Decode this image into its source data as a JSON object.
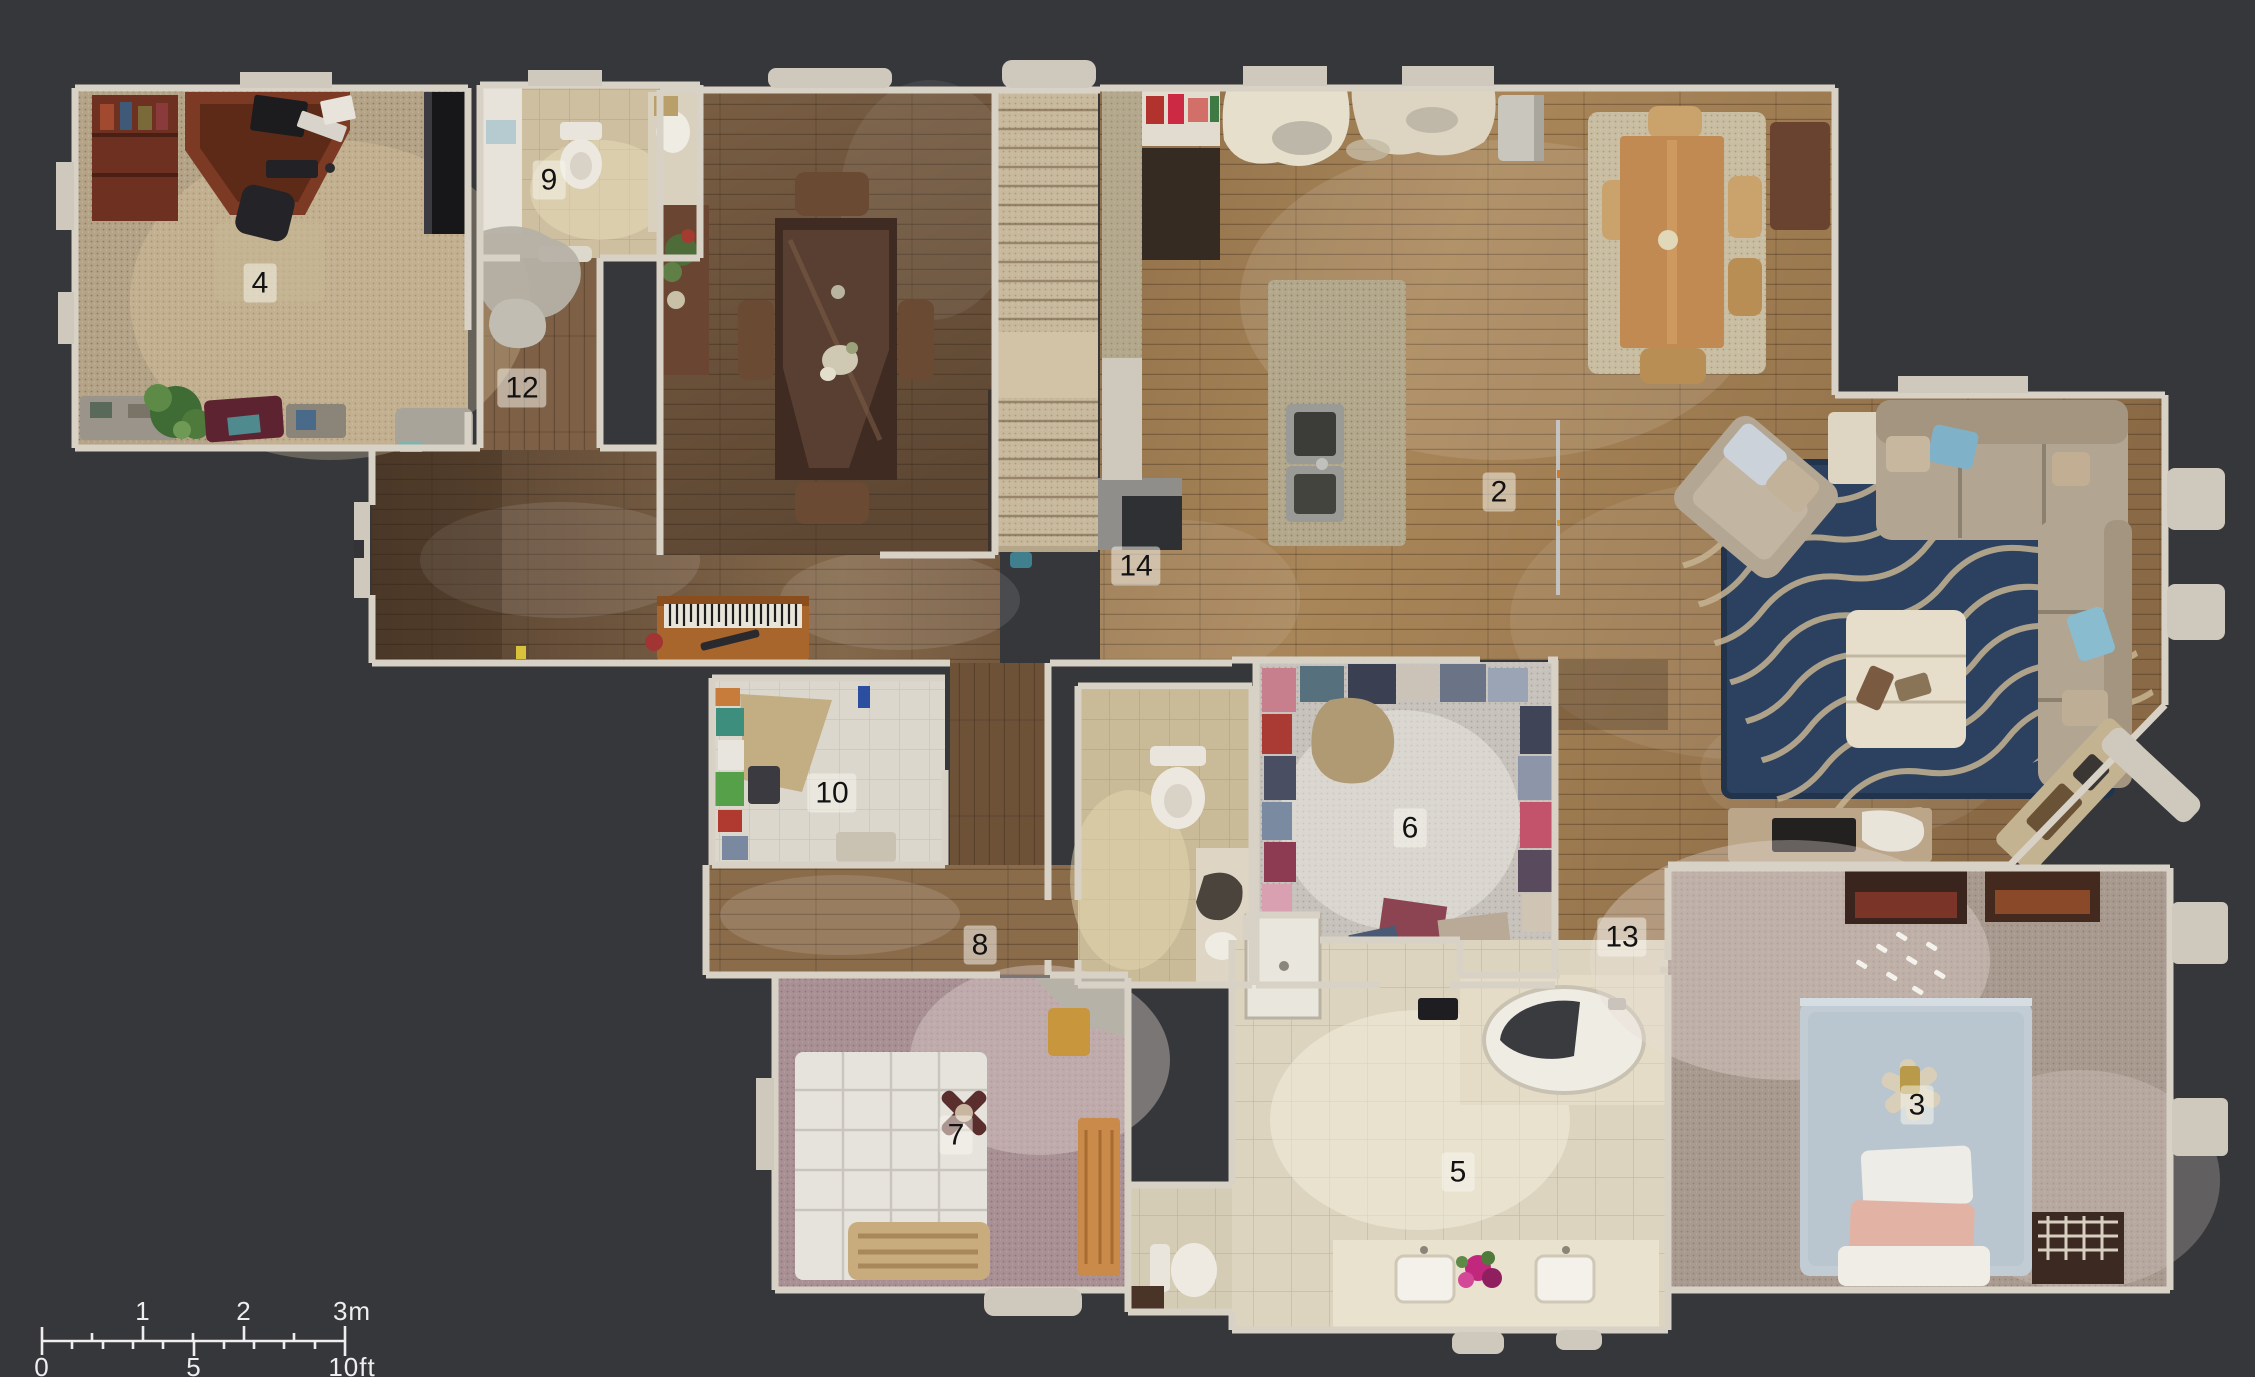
{
  "app": {
    "view_name": "floor-plan-view"
  },
  "palette": {
    "background": "#36373b",
    "wall": "#d8d2c6",
    "sill": "#cfc9bd",
    "wood_dark": "#6b523c",
    "wood_honey": "#a5815a",
    "wood_mid": "#7d6045",
    "carpet_office": "#b4a386",
    "carpet_bedroom7": "#a89095",
    "carpet_bedroom3": "#a99a90",
    "carpet_closet": "#c7c3bc",
    "stair_carpet": "#c9b99c",
    "tile_bath9": "#cdbfa0",
    "tile_bath_small": "#c9ba98",
    "tile_bath5": "#ddd4bf",
    "tile_laundry": "#dcd7cd",
    "rug_blue": "#2c4160",
    "rug_wave": "#c6b492",
    "rug_breakfast": "#c9bda2",
    "sofa": "#b2a591",
    "label_bg": "rgba(248,245,238,0.52)",
    "label_text": "#121212",
    "scale_color": "#eeeeee"
  },
  "floorplan": {
    "room_labels": [
      {
        "number": "2",
        "x": 1499,
        "y": 492
      },
      {
        "number": "3",
        "x": 1917,
        "y": 1105
      },
      {
        "number": "4",
        "x": 260,
        "y": 283
      },
      {
        "number": "5",
        "x": 1458,
        "y": 1172
      },
      {
        "number": "6",
        "x": 1410,
        "y": 828
      },
      {
        "number": "7",
        "x": 956,
        "y": 1135
      },
      {
        "number": "8",
        "x": 980,
        "y": 945
      },
      {
        "number": "9",
        "x": 549,
        "y": 180
      },
      {
        "number": "10",
        "x": 832,
        "y": 793
      },
      {
        "number": "12",
        "x": 522,
        "y": 388
      },
      {
        "number": "13",
        "x": 1622,
        "y": 937
      },
      {
        "number": "14",
        "x": 1136,
        "y": 566
      }
    ]
  },
  "scale_bar": {
    "meter_tick_1": "1",
    "meter_tick_2": "2",
    "meter_tick_3": "3m",
    "feet_tick_0": "0",
    "feet_tick_5": "5",
    "feet_tick_10": "10ft"
  }
}
